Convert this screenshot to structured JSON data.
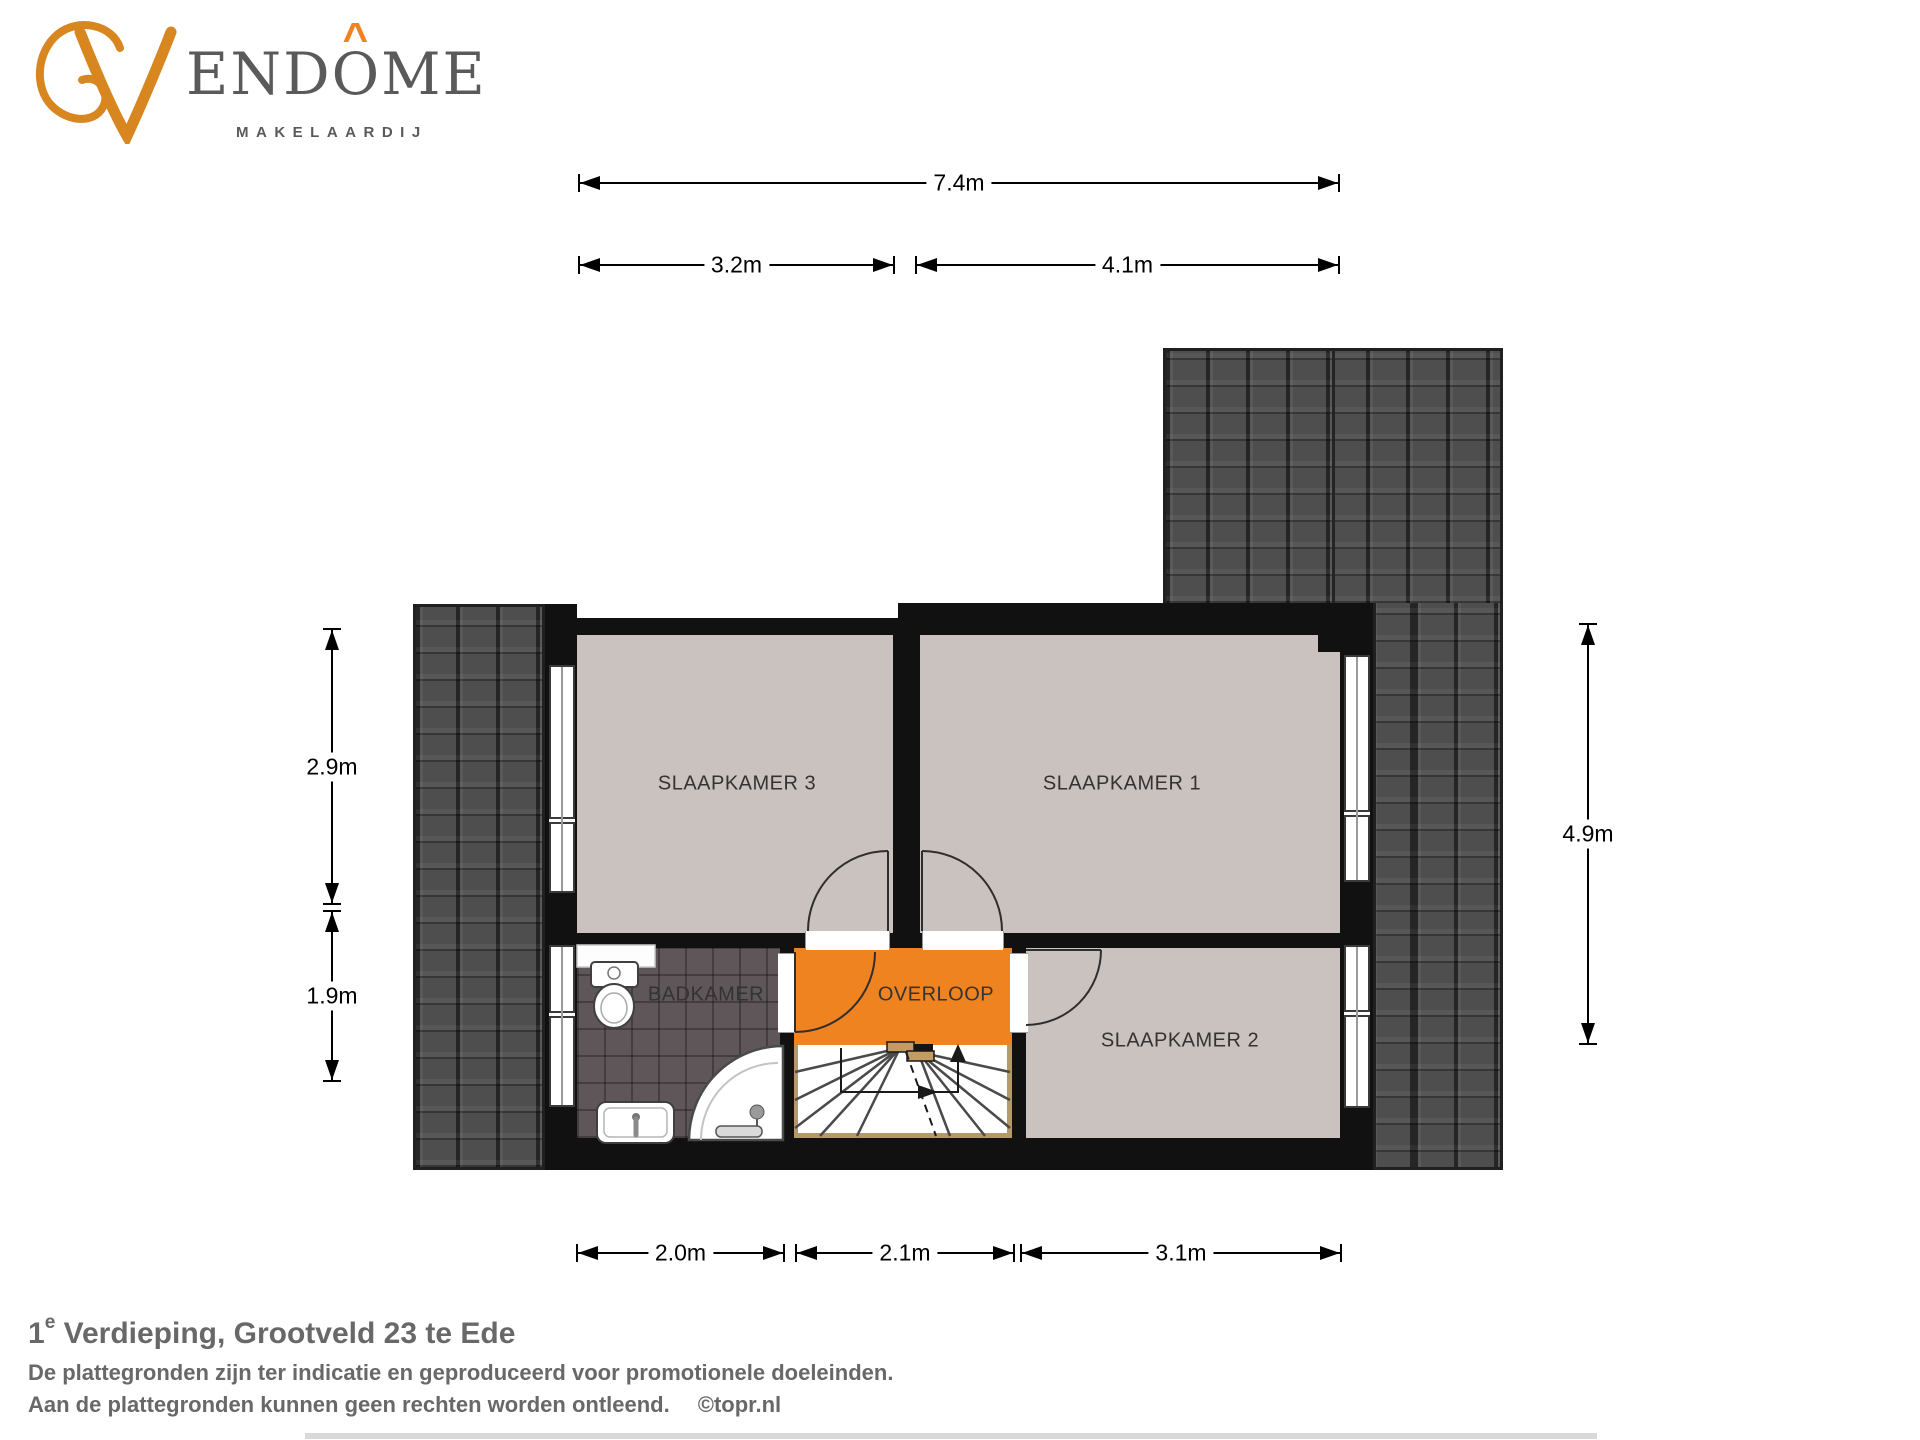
{
  "logo": {
    "wordmark_prefix": "END",
    "wordmark_o": "O",
    "wordmark_suffix": "ME",
    "accent": "^",
    "subtitle": "MAKELAARDIJ"
  },
  "rooms": {
    "sk3": "SLAAPKAMER 3",
    "sk1": "SLAAPKAMER 1",
    "sk2": "SLAAPKAMER 2",
    "badkamer": "BADKAMER",
    "overloop": "OVERLOOP"
  },
  "dims": {
    "total_width": "7.4m",
    "sk3_width": "3.2m",
    "sk1_width": "4.1m",
    "left_upper_height": "2.9m",
    "left_lower_height": "1.9m",
    "right_height": "4.9m",
    "badkamer_width": "2.0m",
    "overloop_width": "2.1m",
    "sk2_width": "3.1m"
  },
  "footer": {
    "title_num": "1",
    "title_sup": "e",
    "title_text": " Verdieping, Grootveld 23 te Ede",
    "disclaimer1": "De plattegronden zijn ter indicatie en geproduceerd voor promotionele doeleinden.",
    "disclaimer2": "Aan de plattegronden kunnen geen rechten worden ontleend.",
    "credit": "©topr.nl"
  },
  "colors": {
    "accent_orange": "#EF8320",
    "roof_gray": "#4E4E4E",
    "room_floor": "#CAC2BE",
    "bathroom_floor": "#5E5659",
    "wall_black": "#111111",
    "stair_trim": "#B5996B",
    "text_gray": "#686868"
  }
}
